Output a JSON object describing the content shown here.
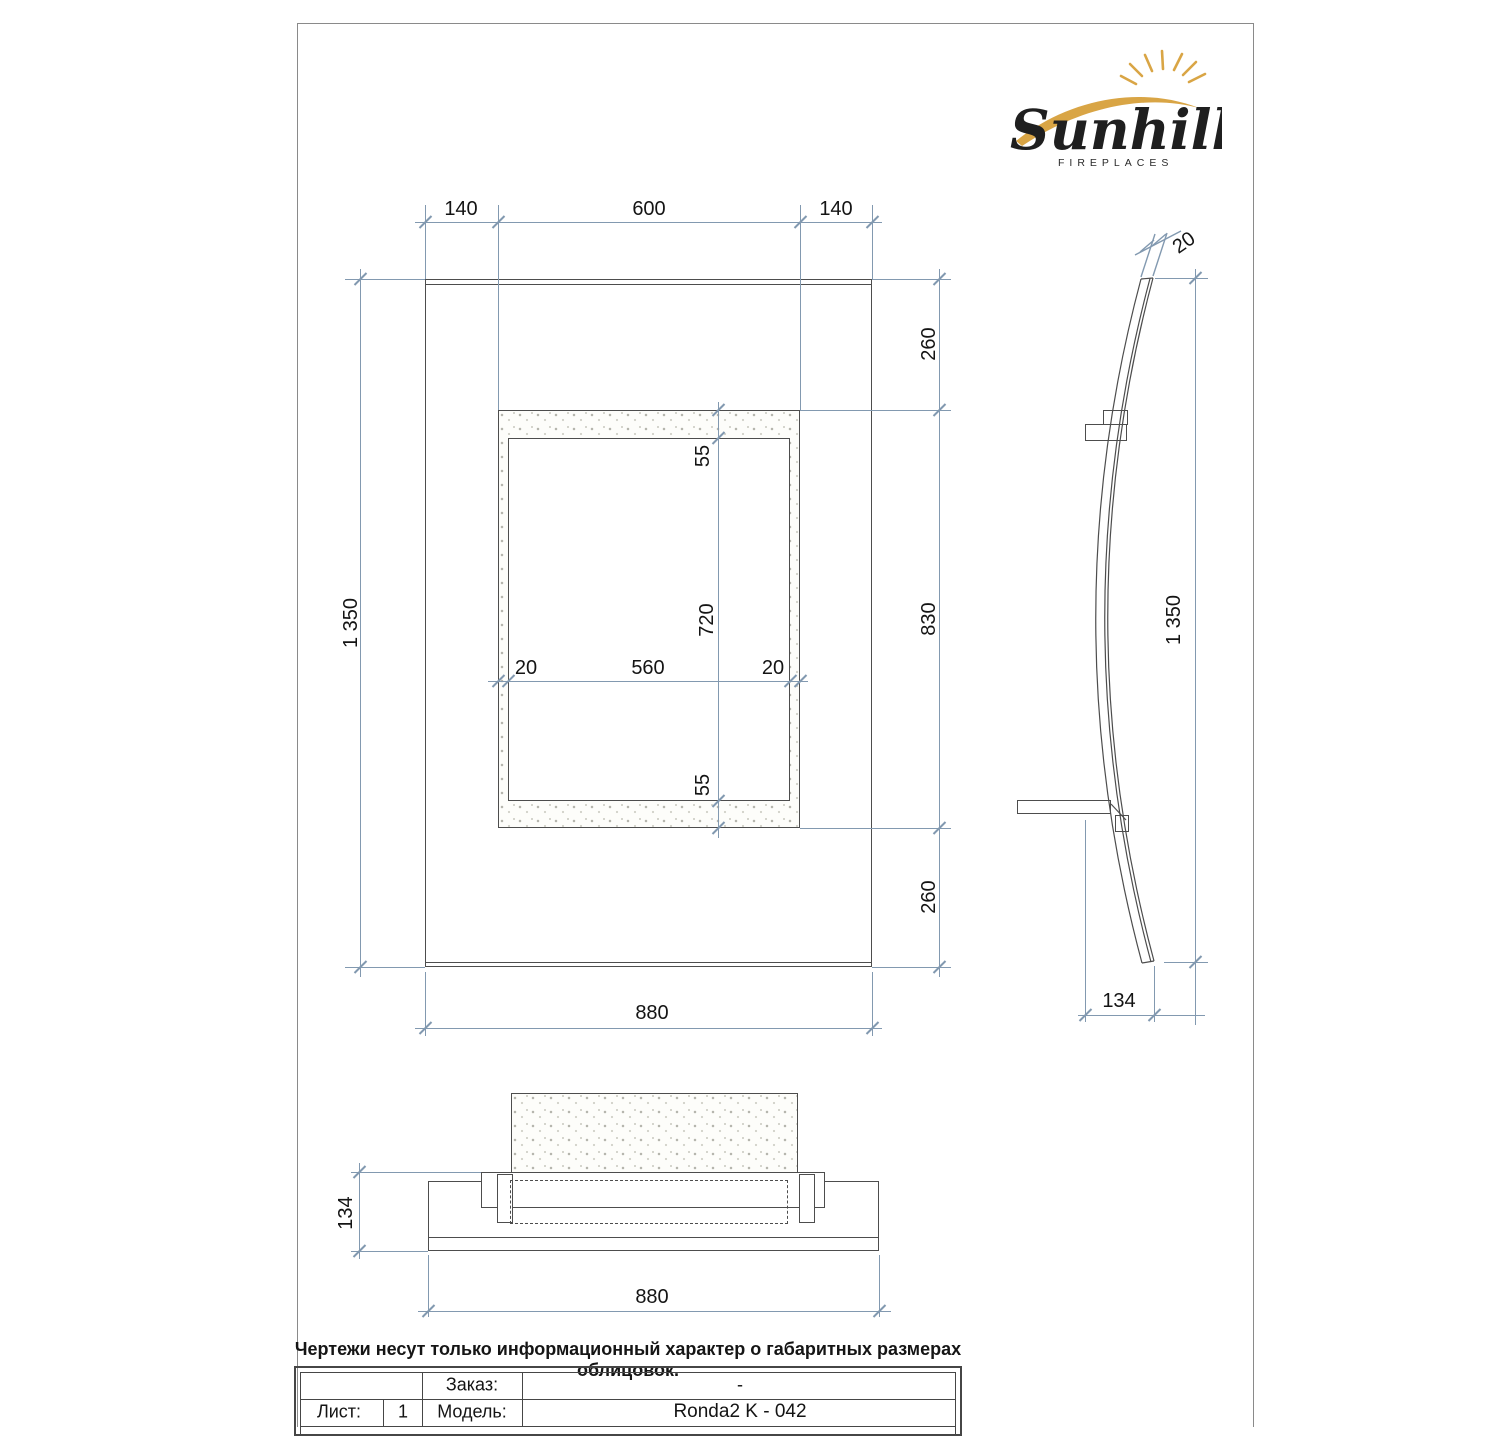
{
  "logo": {
    "brand": "Sunhill",
    "tagline": "FIREPLACES"
  },
  "front_view": {
    "top_dims": [
      "140",
      "600",
      "140"
    ],
    "height_dim": "1 350",
    "right_dims": [
      "260",
      "830",
      "260"
    ],
    "opening_width_dims": [
      "20",
      "560",
      "20"
    ],
    "opening_height_dims": [
      "55",
      "720",
      "55"
    ],
    "width_dim": "880"
  },
  "side_view": {
    "thickness_dim": "20",
    "height_dim": "1 350",
    "depth_dim": "134"
  },
  "plan_view": {
    "depth_dim": "134",
    "width_dim": "880"
  },
  "footnote": "Чертежи несут только информационный характер о габаритных размерах облицовок.",
  "title_block": {
    "sheet_label": "Лист:",
    "sheet_value": "1",
    "order_label": "Заказ:",
    "order_value": "-",
    "model_label": "Модель:",
    "model_value": "Ronda2 K - 042"
  },
  "colors": {
    "dimension": "#8299b0",
    "line": "#4d4d4d",
    "gold": "#D9A545"
  }
}
